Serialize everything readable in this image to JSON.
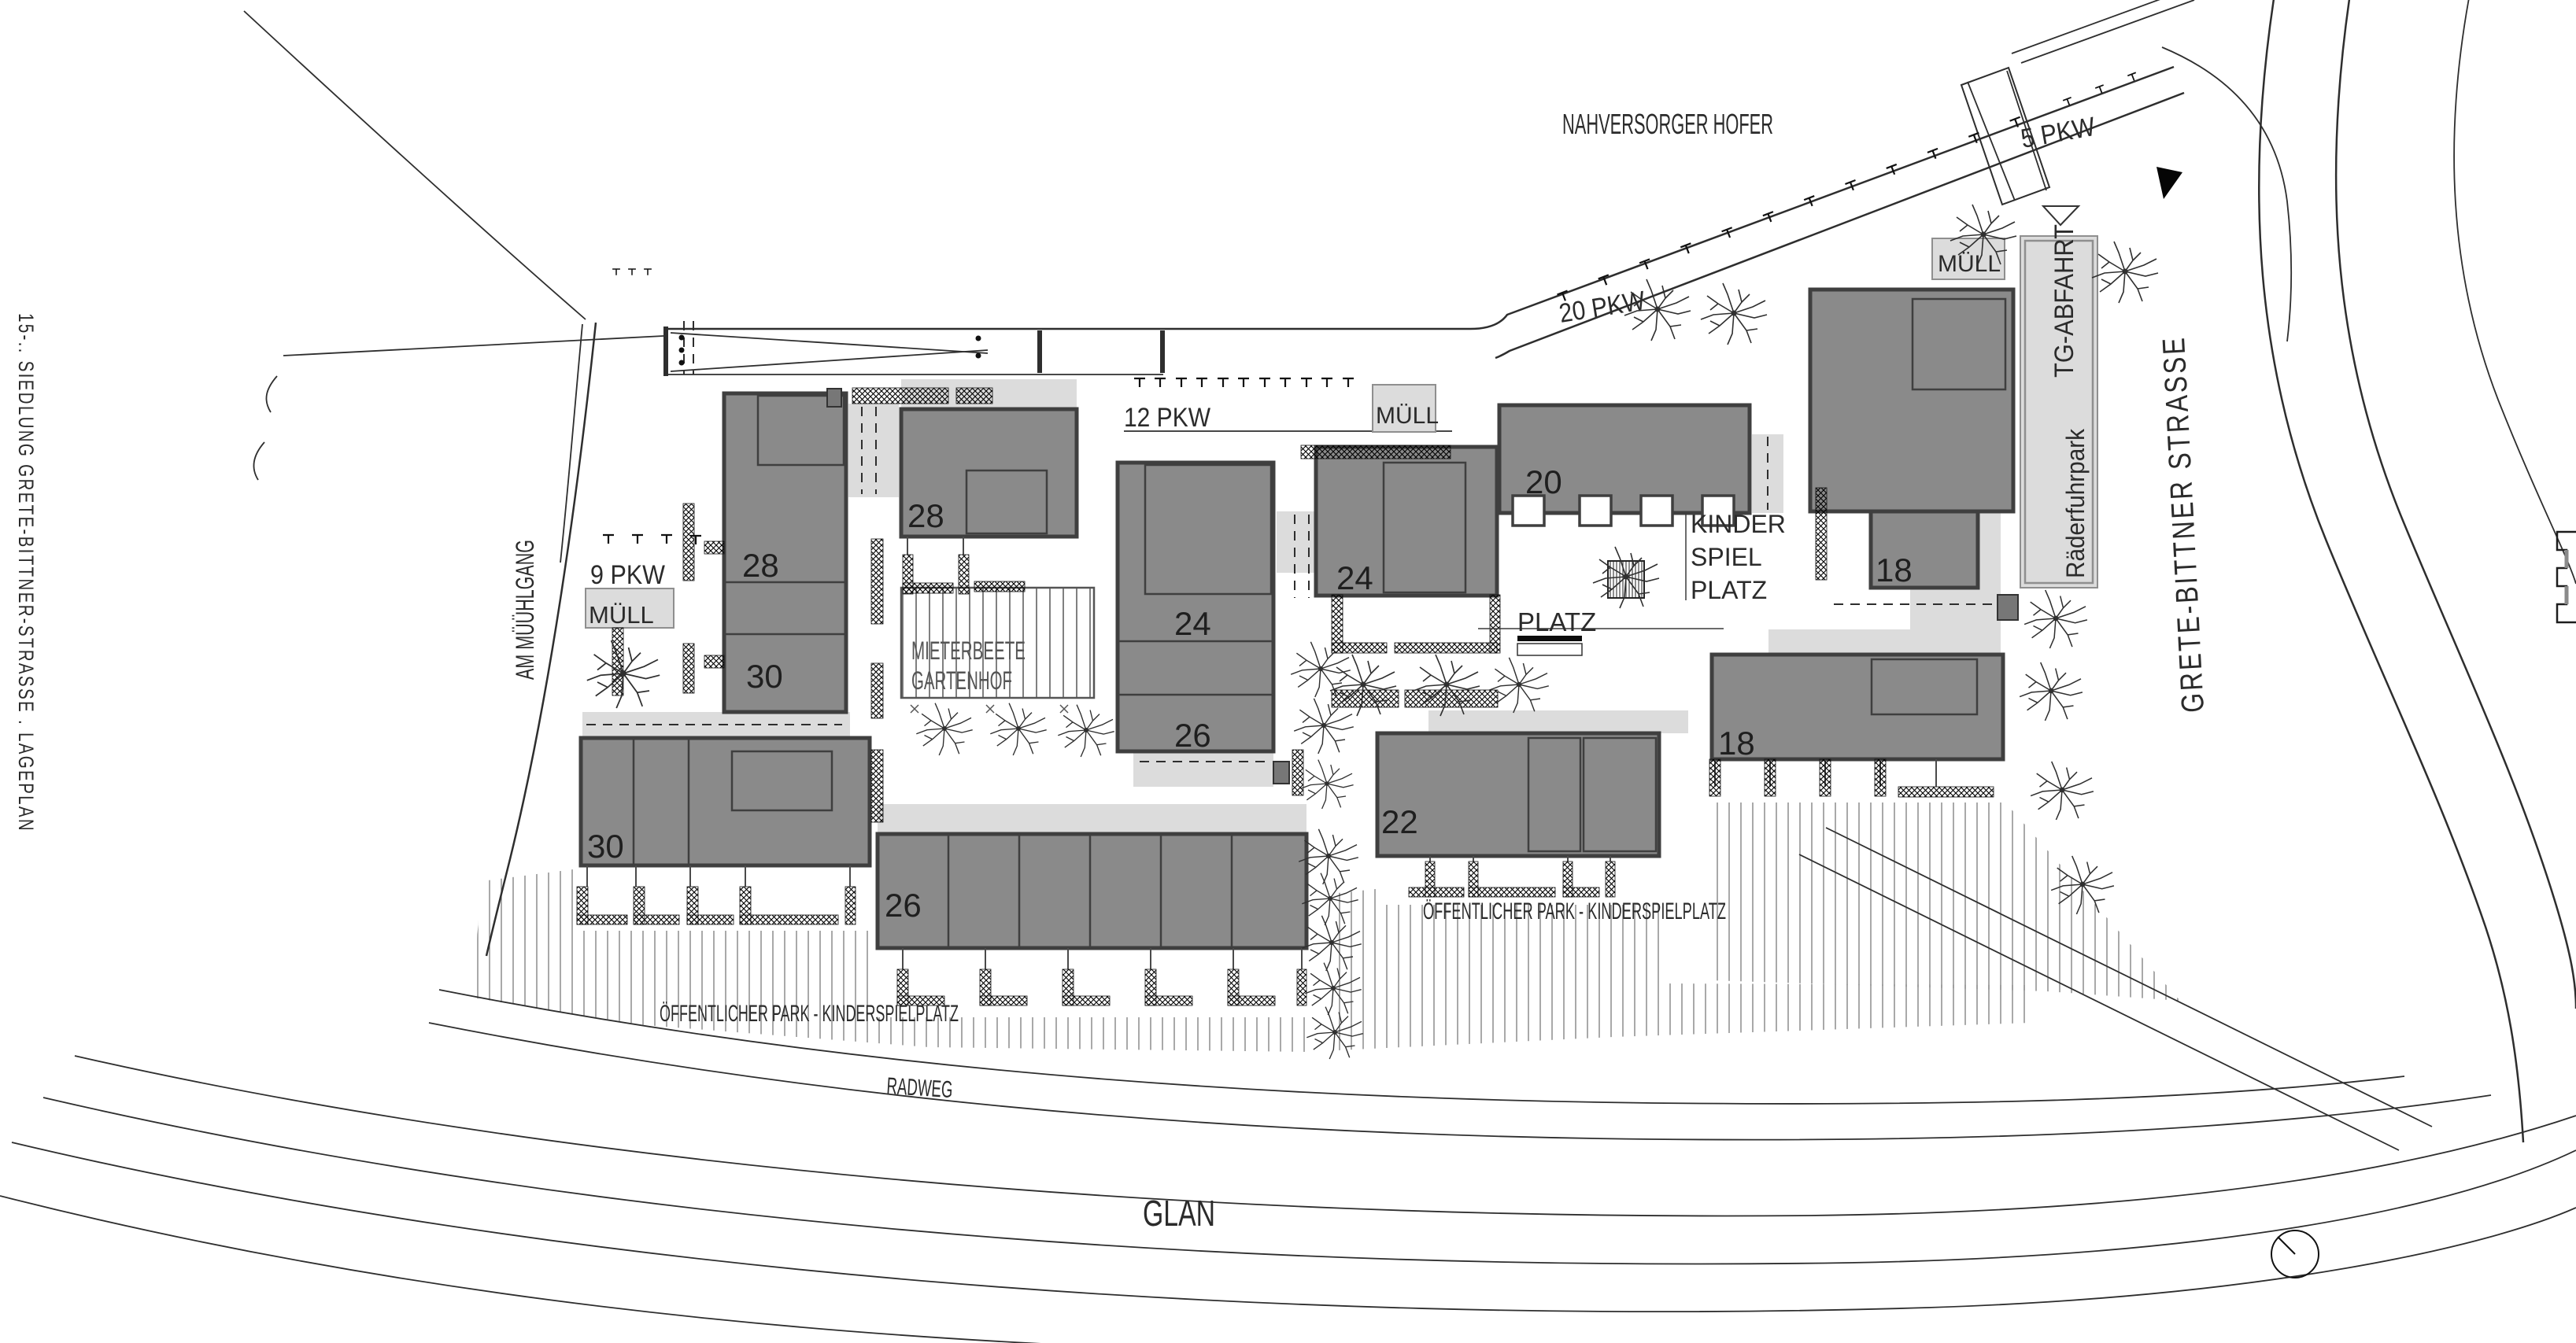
{
  "drawing": {
    "title_margin": "15-.. SIEDLUNG GRETE-BITTNER-STRASSE . LAGEPLAN",
    "river": "GLAN",
    "bike_path": "RADWEG"
  },
  "streets": {
    "left": "AM MÜÜHLGANG",
    "right": "GRETE-BITTNER STRASSE"
  },
  "labels": {
    "supermarket": "NAHVERSORGER HOFER",
    "garage_ramp": "TG-ABFAHRT",
    "bike_park": "Räderfuhrpark",
    "tenant_beds_1": "MIETERBEETE",
    "tenant_beds_2": "GARTENHOF",
    "playground_1": "KINDER",
    "playground_2": "SPIEL",
    "playground_3": "PLATZ",
    "square": "PLATZ",
    "park_west": "ÖFFENTLICHER PARK - KINDERSPIELPLATZ",
    "park_east": "ÖFFENTLICHER PARK - KINDERSPIELPLATZ"
  },
  "parking": {
    "p5": "5 PKW",
    "p9": "9 PKW",
    "p12": "12 PKW",
    "p20": "20 PKW"
  },
  "waste": {
    "w_left": "MÜLL",
    "w_mid": "MÜLL",
    "w_right": "MÜLL"
  },
  "houses": {
    "h28_west": "28",
    "h30_west": "30",
    "h28_north": "28",
    "h30_south": "30",
    "h26_south": "26",
    "h24_mid": "24",
    "h26_mid": "26",
    "h24_east": "24",
    "h22": "22",
    "h20": "20",
    "h18_north": "18",
    "h18_south": "18"
  },
  "symbols": {
    "north_arrow": "north-arrow",
    "entrance_marker": "entrance-triangle",
    "survey_circle": "survey-circle",
    "edge_crenellation": "plan-edge-marker"
  },
  "colors": {
    "paper": "#ffffff",
    "building_fill": "#8a8a8a",
    "building_stroke": "#3f3f3f",
    "light_area": "#dcdcdc",
    "line": "#2e2e2e"
  }
}
